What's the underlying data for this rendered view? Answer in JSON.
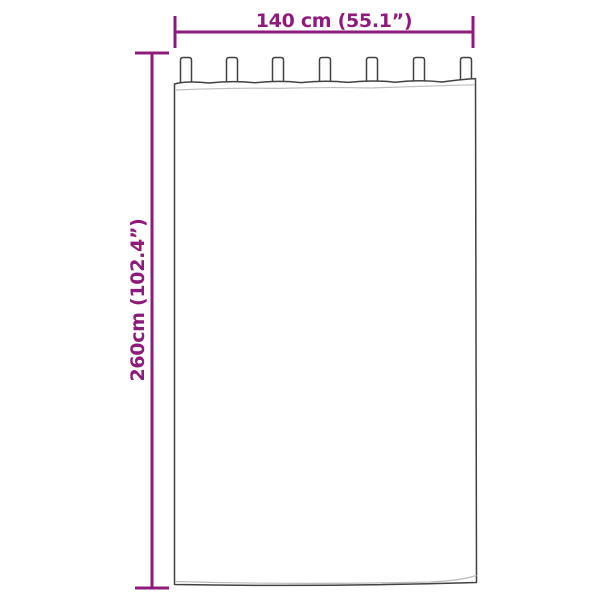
{
  "diagram": {
    "width_label": "140 cm (55.1”)",
    "height_label": "260cm (102.4”)",
    "tab_count": "7",
    "colors": {
      "dimension": "#8E1B7B",
      "outline": "#414141",
      "seam": "#BCBCBC",
      "fill": "#FFFFFF"
    }
  }
}
